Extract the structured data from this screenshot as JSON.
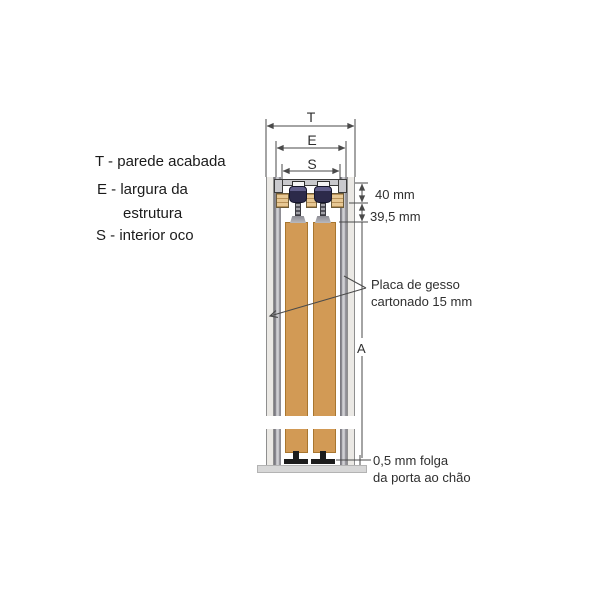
{
  "legend": {
    "t": "T - parede acabada",
    "e_line1": "E - largura da",
    "e_line2": "estrutura",
    "s": "S - interior oco"
  },
  "dimensions": {
    "total_width": "T",
    "structure_width": "E",
    "hollow_interior": "S",
    "track_height": "40 mm",
    "clearance": "39,5 mm",
    "wall_height": "A"
  },
  "callouts": {
    "plasterboard_line1": "Placa de gesso",
    "plasterboard_line2": "cartonado 15 mm",
    "floor_gap_line1": "0,5 mm folga",
    "floor_gap_line2": "da porta ao chão"
  },
  "colors": {
    "door_panel": "#d29a55",
    "plasterboard": "#ebe9e5",
    "metal_stud": "#8f8e94",
    "track_metal": "#c9c9cd",
    "roller": "#2c2a4a",
    "wood_block": "#e7c894",
    "floor": "#d7d7d7",
    "drawing_line": "#4a4a4a"
  }
}
